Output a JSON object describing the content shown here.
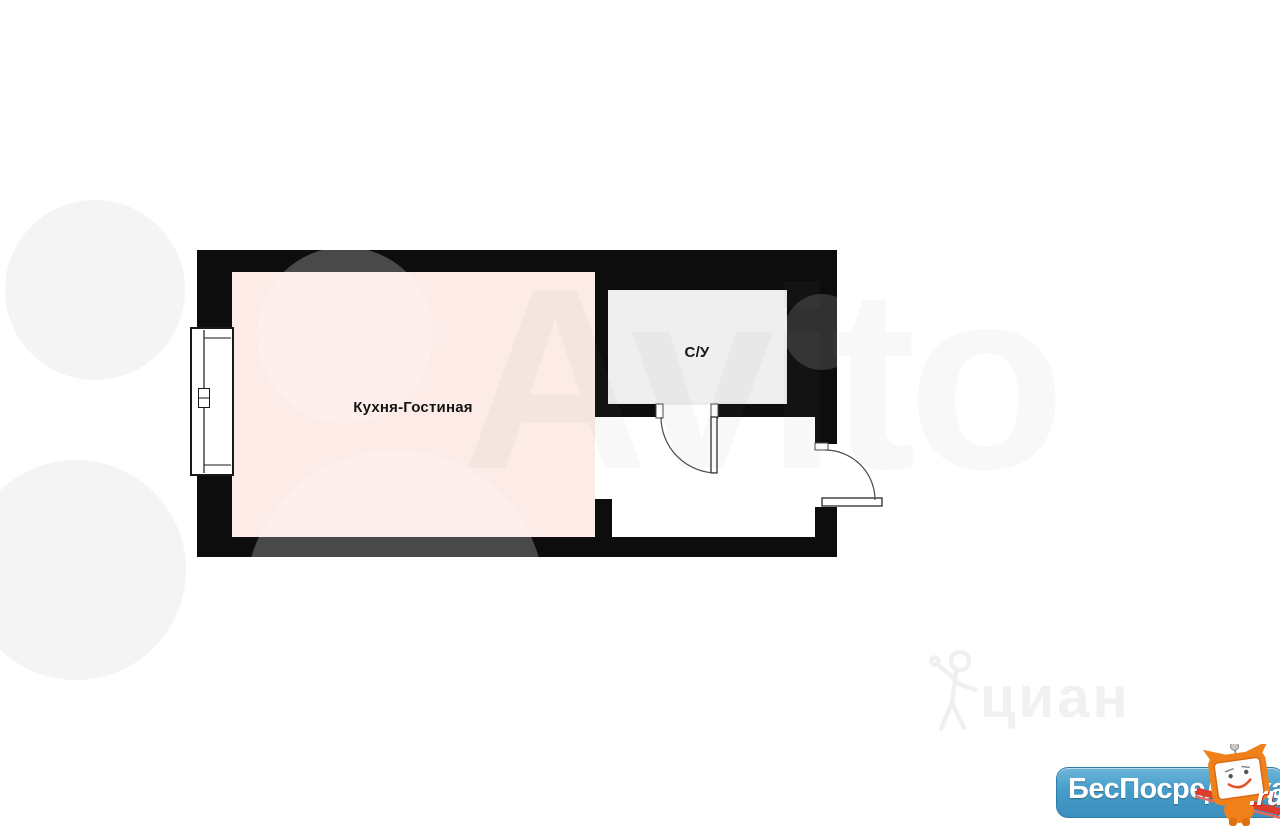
{
  "plan": {
    "wall_color": "#0d0d0d",
    "kitchen": {
      "label": "Кухня-Гостиная",
      "fill": "#fcebe6"
    },
    "bathroom": {
      "label": "С/У",
      "fill": "#efefef"
    },
    "hall_fill": "#ffffff"
  },
  "watermarks": {
    "avito": "Avito",
    "cian": "циан"
  },
  "logo": {
    "name": "БесПосредника",
    "suffix": ".ru",
    "bg_color": "#459dc9",
    "mascot_color": "#f0811a"
  }
}
